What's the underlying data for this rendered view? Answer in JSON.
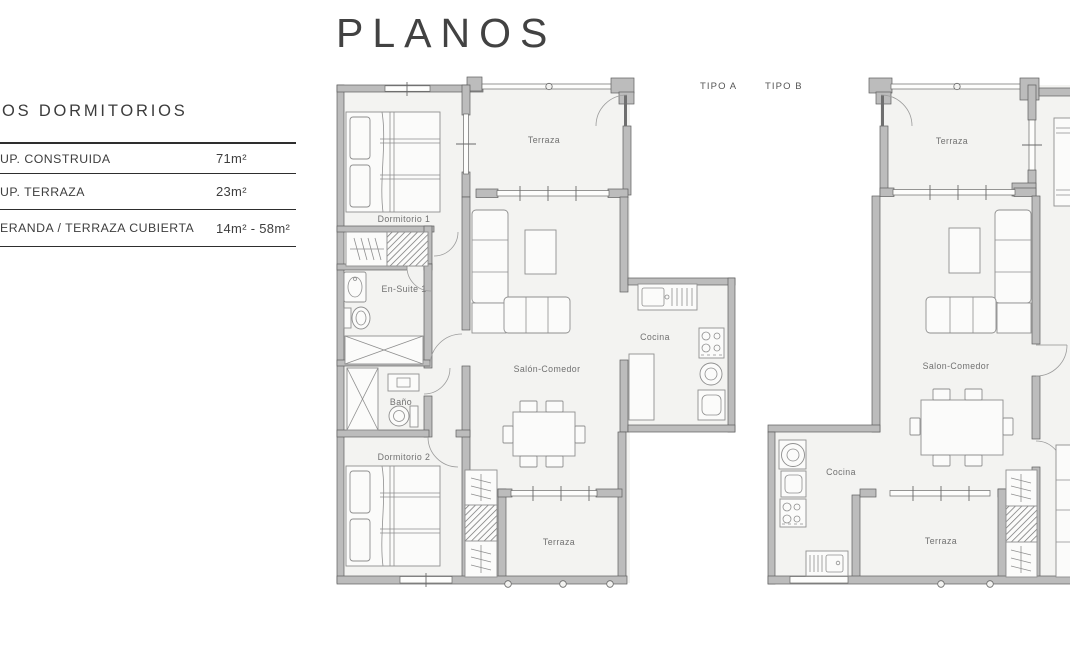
{
  "title": "PLANOS",
  "info_panel": {
    "heading": "OS DORMITORIOS",
    "rows": [
      {
        "label": "UP.  CONSTRUIDA",
        "value": "71m²"
      },
      {
        "label": "UP. TERRAZA",
        "value": "23m²"
      },
      {
        "label": "ERANDA / TERRAZA CUBIERTA",
        "value": "14m² - 58m²"
      }
    ]
  },
  "type_labels": {
    "tipo_a": "TIPO A",
    "tipo_b": "TIPO B"
  },
  "plan_a": {
    "rooms": {
      "terraza_top": "Terraza",
      "dormitorio_1": "Dormitorio 1",
      "en_suite_1": "En-Suite 1",
      "bano": "Baño",
      "dormitorio_2": "Dormitorio 2",
      "salon_comedor": "Salón-Comedor",
      "cocina": "Cocina",
      "terraza_bottom": "Terraza"
    }
  },
  "plan_b": {
    "rooms": {
      "terraza_top": "Terraza",
      "salon_comedor": "Salon-Comedor",
      "cocina": "Cocina",
      "terraza_bottom": "Terraza"
    }
  },
  "colors": {
    "wall": "#bcbcbc",
    "room_fill": "#f3f3f1",
    "heading_text": "#3c3c3c",
    "room_label": "#717171"
  }
}
